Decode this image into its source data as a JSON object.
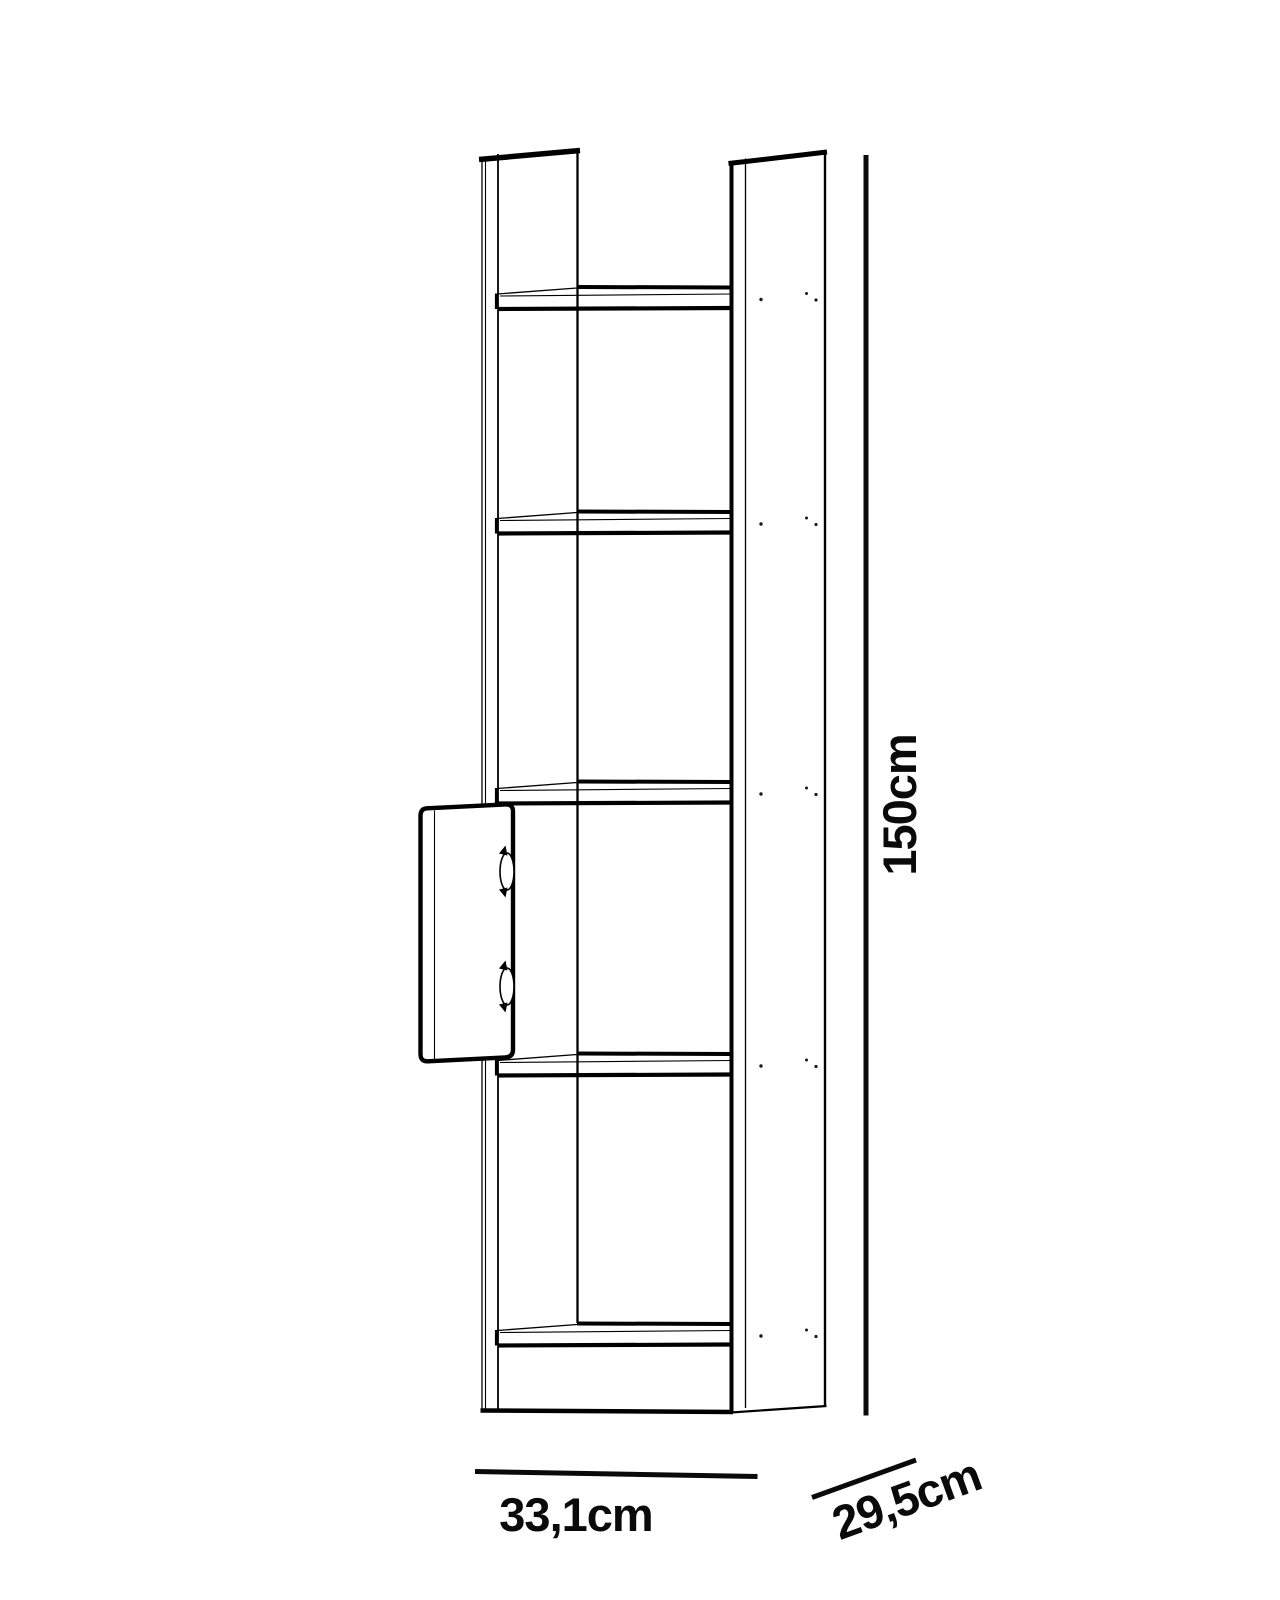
{
  "page": {
    "background_color": "#ffffff",
    "line_color": "#000000"
  },
  "diagram": {
    "kind": "furniture-dimension-drawing",
    "subject": "tall narrow bookcase with five shelves and an open hinged door",
    "shelf_count": 5,
    "hinge_count": 2,
    "dimensions": {
      "height": {
        "label": "150cm",
        "value_cm": 150,
        "orientation": "vertical"
      },
      "width": {
        "label": "33,1cm",
        "value_cm": 33.1,
        "orientation": "horizontal"
      },
      "depth": {
        "label": "29,5cm",
        "value_cm": 29.5,
        "orientation": "diagonal"
      }
    }
  }
}
